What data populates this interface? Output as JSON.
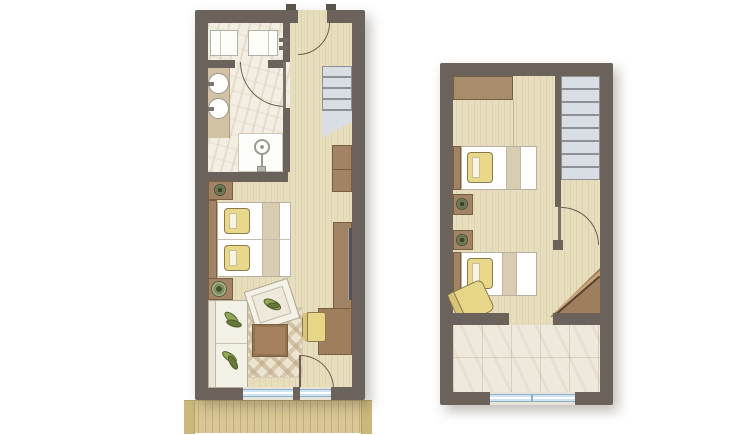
{
  "palette": {
    "wall": "#6b635b",
    "floor": "#e8debc",
    "bath_tile": "#f2eee4",
    "loggia_tile": "#efe9dd",
    "stair": "#d9dde4",
    "stair_edge": "#8f9094",
    "furniture": "#a28366",
    "furniture_edge": "#77603f",
    "wardrobe": "#a88d6c",
    "bed": "#ffffff",
    "bed_edge": "#b8b0a0",
    "blanket": "#d8cdb3",
    "pillow": "#e9d88a",
    "pillow_edge": "#8b7b4a",
    "cushion": "#93a556",
    "cushion_dark": "#66773a",
    "rug": "#ece4d0",
    "rug_pattern": "#b9a580",
    "window": "#cfe4f2",
    "window_edge": "#8fb0c6",
    "balcony": "#d9c795",
    "balcony_edge": "#cbb87f",
    "tv": "#515156",
    "door": "#6b5f50",
    "canvas": "#ffffff"
  },
  "scene": {
    "type": "architectural floor plan, top view, no text labels",
    "plans": [
      {
        "name": "lower-level-suite",
        "rooms": [
          {
            "name": "bathroom",
            "fixtures": [
              "toilet",
              "second-toilet-bidet",
              "double-vanity-two-basins",
              "shower",
              "bathroom-door"
            ]
          },
          {
            "name": "entry-hall",
            "features": [
              "entry-door",
              "staircase-with-winder",
              "tall-wardrobe"
            ]
          },
          {
            "name": "bedroom",
            "furniture": [
              "headboard-panel",
              "bedside-lamp",
              "twin-beds-with-yellow-pillows",
              "blanket-runner",
              "sideboard",
              "wall-tv"
            ]
          },
          {
            "name": "living-area",
            "furniture": [
              "side-table-with-plant",
              "sofa-green-cushions",
              "tilted-armchair",
              "patterned-rug",
              "coffee-table",
              "desk",
              "desk-chair"
            ]
          },
          {
            "name": "balcony",
            "features": [
              "glazed-balcony-door",
              "two-windows",
              "plank-deck"
            ]
          }
        ]
      },
      {
        "name": "upper-level-suite",
        "rooms": [
          {
            "name": "bedroom",
            "furniture": [
              "wardrobe",
              "single-bed-1",
              "single-bed-2",
              "nightstand-1",
              "nightstand-2",
              "bedside-lamps",
              "yellow-armchair",
              "corner-desk"
            ]
          },
          {
            "name": "stairwell",
            "features": [
              "eight-step-staircase",
              "partition-wall",
              "stair-door"
            ]
          },
          {
            "name": "loggia",
            "features": [
              "tiled-floor",
              "wide-window"
            ]
          }
        ]
      }
    ]
  }
}
